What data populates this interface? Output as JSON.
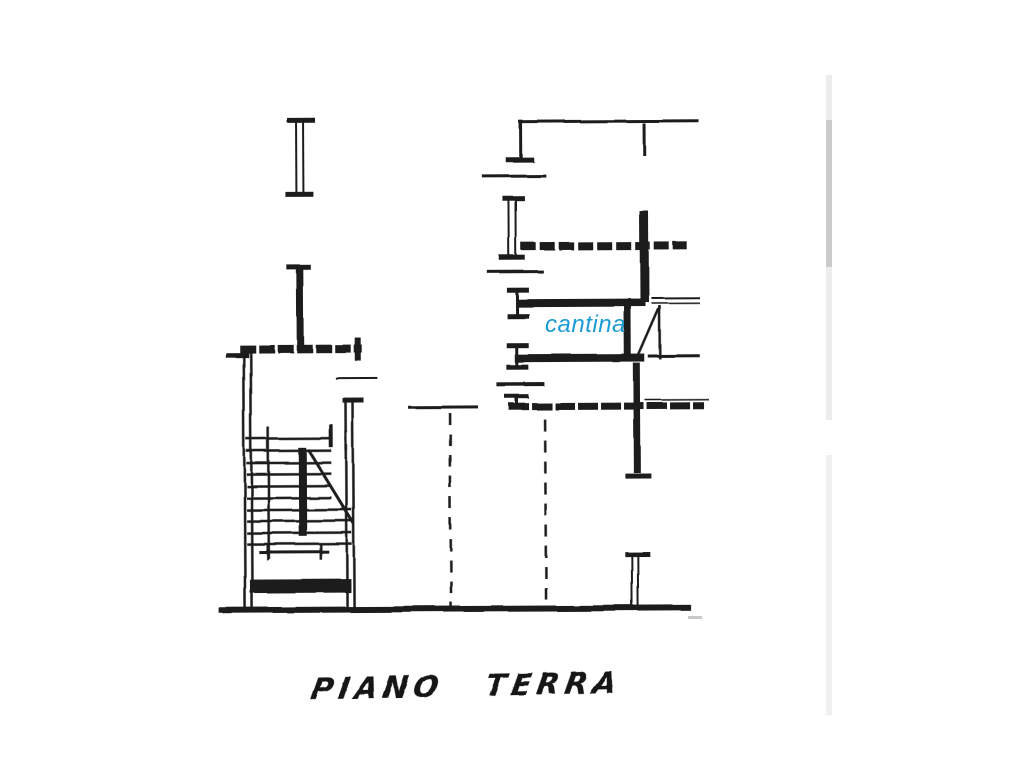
{
  "page": {
    "background": "#ffffff",
    "ink": "#1a1a1a"
  },
  "labels": {
    "cantina": {
      "text": "cantina",
      "color": "#1b9bd7"
    },
    "floor_title": {
      "text": "PIANO TERRA"
    }
  },
  "floorplan": {
    "stroke": "#1a1a1a",
    "segments": [
      {
        "n": "wall-cap",
        "x1": 288,
        "y1": 119,
        "x2": 316,
        "y2": 119,
        "w": 5
      },
      {
        "n": "wall-line",
        "x1": 297,
        "y1": 121,
        "x2": 297,
        "y2": 195,
        "w": 2
      },
      {
        "n": "wall-line",
        "x1": 304,
        "y1": 121,
        "x2": 304,
        "y2": 195,
        "w": 2
      },
      {
        "n": "wall-cap",
        "x1": 286,
        "y1": 193,
        "x2": 314,
        "y2": 193,
        "w": 5
      },
      {
        "n": "wall-cap",
        "x1": 288,
        "y1": 267,
        "x2": 312,
        "y2": 267,
        "w": 5
      },
      {
        "n": "wall",
        "x1": 301,
        "y1": 269,
        "x2": 301,
        "y2": 347,
        "w": 7
      },
      {
        "n": "wall",
        "x1": 240,
        "y1": 348,
        "x2": 362,
        "y2": 348,
        "w": 8,
        "dash": "16 3"
      },
      {
        "n": "wall-cap",
        "x1": 358,
        "y1": 337,
        "x2": 358,
        "y2": 360,
        "w": 6
      },
      {
        "n": "wall-stub",
        "x1": 226,
        "y1": 354,
        "x2": 249,
        "y2": 354,
        "w": 5
      },
      {
        "n": "wall-line",
        "x1": 244,
        "y1": 345,
        "x2": 244,
        "y2": 610,
        "w": 2.5
      },
      {
        "n": "wall-line",
        "x1": 251,
        "y1": 345,
        "x2": 251,
        "y2": 610,
        "w": 2.5
      },
      {
        "n": "wall-cap",
        "x1": 343,
        "y1": 400,
        "x2": 364,
        "y2": 400,
        "w": 5
      },
      {
        "n": "wall-line",
        "x1": 346,
        "y1": 401,
        "x2": 346,
        "y2": 610,
        "w": 2.5
      },
      {
        "n": "wall-line",
        "x1": 353,
        "y1": 401,
        "x2": 353,
        "y2": 610,
        "w": 2.5
      },
      {
        "n": "thin-line",
        "x1": 335,
        "y1": 377,
        "x2": 377,
        "y2": 377,
        "w": 2
      },
      {
        "n": "stair-step",
        "x1": 246,
        "y1": 438,
        "x2": 331,
        "y2": 438,
        "w": 2.5
      },
      {
        "n": "stair-step",
        "x1": 246,
        "y1": 450,
        "x2": 331,
        "y2": 450,
        "w": 2.5
      },
      {
        "n": "stair-step",
        "x1": 246,
        "y1": 462,
        "x2": 331,
        "y2": 462,
        "w": 2.5
      },
      {
        "n": "stair-step",
        "x1": 246,
        "y1": 473,
        "x2": 331,
        "y2": 473,
        "w": 2.5
      },
      {
        "n": "stair-step",
        "x1": 246,
        "y1": 485,
        "x2": 331,
        "y2": 485,
        "w": 2.5
      },
      {
        "n": "stair-step",
        "x1": 246,
        "y1": 497,
        "x2": 331,
        "y2": 497,
        "w": 2.5
      },
      {
        "n": "stair-step",
        "x1": 246,
        "y1": 509,
        "x2": 351,
        "y2": 509,
        "w": 2.5
      },
      {
        "n": "stair-step",
        "x1": 246,
        "y1": 520,
        "x2": 351,
        "y2": 520,
        "w": 2.5
      },
      {
        "n": "stair-step",
        "x1": 246,
        "y1": 532,
        "x2": 351,
        "y2": 532,
        "w": 2.5
      },
      {
        "n": "stair-step",
        "x1": 246,
        "y1": 543,
        "x2": 351,
        "y2": 543,
        "w": 2.5
      },
      {
        "n": "stair-stringer",
        "x1": 268,
        "y1": 426,
        "x2": 268,
        "y2": 558,
        "w": 2.5
      },
      {
        "n": "stair-rail",
        "x1": 302,
        "y1": 447,
        "x2": 302,
        "y2": 535,
        "w": 8
      },
      {
        "n": "stair-break-line",
        "x1": 308,
        "y1": 449,
        "x2": 353,
        "y2": 523,
        "w": 3
      },
      {
        "n": "stair-tick",
        "x1": 331,
        "y1": 424,
        "x2": 331,
        "y2": 447,
        "w": 4
      },
      {
        "n": "stair-tick",
        "x1": 346,
        "y1": 430,
        "x2": 346,
        "y2": 450,
        "w": 2.5
      },
      {
        "n": "landing-line",
        "x1": 258,
        "y1": 551,
        "x2": 328,
        "y2": 551,
        "w": 3
      },
      {
        "n": "landing-tick",
        "x1": 267,
        "y1": 543,
        "x2": 267,
        "y2": 559,
        "w": 2.5
      },
      {
        "n": "landing-tick",
        "x1": 320,
        "y1": 543,
        "x2": 320,
        "y2": 559,
        "w": 2.5
      },
      {
        "n": "threshold-bar",
        "x1": 249,
        "y1": 585,
        "x2": 350,
        "y2": 585,
        "w": 14
      },
      {
        "n": "ground-line",
        "x1": 218,
        "y1": 609,
        "x2": 690,
        "y2": 609,
        "w": 6
      },
      {
        "n": "wall-line",
        "x1": 520,
        "y1": 122,
        "x2": 700,
        "y2": 122,
        "w": 3
      },
      {
        "n": "wall-line",
        "x1": 522,
        "y1": 122,
        "x2": 522,
        "y2": 158,
        "w": 3
      },
      {
        "n": "wall-cap",
        "x1": 507,
        "y1": 160,
        "x2": 535,
        "y2": 160,
        "w": 5
      },
      {
        "n": "wall-line",
        "x1": 645,
        "y1": 124,
        "x2": 645,
        "y2": 156,
        "w": 3
      },
      {
        "n": "thin-line",
        "x1": 483,
        "y1": 176,
        "x2": 547,
        "y2": 176,
        "w": 3
      },
      {
        "n": "wall-cap",
        "x1": 504,
        "y1": 199,
        "x2": 526,
        "y2": 199,
        "w": 5
      },
      {
        "n": "wall-line",
        "x1": 510,
        "y1": 201,
        "x2": 510,
        "y2": 257,
        "w": 2
      },
      {
        "n": "wall-line",
        "x1": 517,
        "y1": 201,
        "x2": 517,
        "y2": 257,
        "w": 2
      },
      {
        "n": "wall-cap",
        "x1": 500,
        "y1": 258,
        "x2": 526,
        "y2": 258,
        "w": 5
      },
      {
        "n": "wall",
        "x1": 522,
        "y1": 247,
        "x2": 688,
        "y2": 247,
        "w": 8,
        "dash": "15 4"
      },
      {
        "n": "wall",
        "x1": 645,
        "y1": 212,
        "x2": 645,
        "y2": 303,
        "w": 9
      },
      {
        "n": "thin-line",
        "x1": 488,
        "y1": 272,
        "x2": 544,
        "y2": 272,
        "w": 3
      },
      {
        "n": "wall-cap",
        "x1": 507,
        "y1": 290,
        "x2": 529,
        "y2": 290,
        "w": 5
      },
      {
        "n": "wall-line",
        "x1": 517,
        "y1": 292,
        "x2": 517,
        "y2": 315,
        "w": 3
      },
      {
        "n": "wall-cap",
        "x1": 507,
        "y1": 316,
        "x2": 529,
        "y2": 316,
        "w": 5
      },
      {
        "n": "wall",
        "x1": 518,
        "y1": 303,
        "x2": 646,
        "y2": 303,
        "w": 8
      },
      {
        "n": "thin-line",
        "x1": 652,
        "y1": 299,
        "x2": 700,
        "y2": 299,
        "w": 2
      },
      {
        "n": "thin-line",
        "x1": 652,
        "y1": 304,
        "x2": 700,
        "y2": 304,
        "w": 1.5
      },
      {
        "n": "door-jamb",
        "x1": 628,
        "y1": 305,
        "x2": 628,
        "y2": 362,
        "w": 7
      },
      {
        "n": "door-jamb",
        "x1": 660,
        "y1": 306,
        "x2": 660,
        "y2": 360,
        "w": 2.5
      },
      {
        "n": "door-leaf",
        "x1": 660,
        "y1": 308,
        "x2": 637,
        "y2": 360,
        "w": 2.5
      },
      {
        "n": "wall-cap",
        "x1": 507,
        "y1": 346,
        "x2": 529,
        "y2": 346,
        "w": 5
      },
      {
        "n": "wall-line",
        "x1": 517,
        "y1": 348,
        "x2": 517,
        "y2": 367,
        "w": 3
      },
      {
        "n": "wall-cap",
        "x1": 507,
        "y1": 368,
        "x2": 529,
        "y2": 368,
        "w": 5
      },
      {
        "n": "wall",
        "x1": 515,
        "y1": 359,
        "x2": 645,
        "y2": 359,
        "w": 8
      },
      {
        "n": "thin-line",
        "x1": 648,
        "y1": 357,
        "x2": 700,
        "y2": 357,
        "w": 3
      },
      {
        "n": "thin-line",
        "x1": 497,
        "y1": 385,
        "x2": 545,
        "y2": 385,
        "w": 4
      },
      {
        "n": "wall-cap",
        "x1": 505,
        "y1": 397,
        "x2": 529,
        "y2": 397,
        "w": 4
      },
      {
        "n": "wall-line",
        "x1": 517,
        "y1": 398,
        "x2": 517,
        "y2": 407,
        "w": 3
      },
      {
        "n": "wall",
        "x1": 509,
        "y1": 407,
        "x2": 704,
        "y2": 407,
        "w": 7,
        "dash": "20 3"
      },
      {
        "n": "thin-line",
        "x1": 645,
        "y1": 401,
        "x2": 709,
        "y2": 401,
        "w": 1.5
      },
      {
        "n": "wall",
        "x1": 637,
        "y1": 364,
        "x2": 637,
        "y2": 474,
        "w": 7
      },
      {
        "n": "wall-cap",
        "x1": 625,
        "y1": 477,
        "x2": 651,
        "y2": 477,
        "w": 5
      },
      {
        "n": "wall-cap",
        "x1": 624,
        "y1": 555,
        "x2": 649,
        "y2": 555,
        "w": 5
      },
      {
        "n": "wall-line",
        "x1": 631,
        "y1": 557,
        "x2": 631,
        "y2": 609,
        "w": 2
      },
      {
        "n": "wall-line",
        "x1": 637,
        "y1": 557,
        "x2": 637,
        "y2": 609,
        "w": 2
      },
      {
        "n": "thin-line",
        "x1": 408,
        "y1": 407,
        "x2": 478,
        "y2": 407,
        "w": 3
      },
      {
        "n": "dashed-boundary",
        "x1": 450,
        "y1": 413,
        "x2": 450,
        "y2": 608,
        "w": 2.5,
        "dash": "12 9"
      },
      {
        "n": "dashed-boundary",
        "x1": 545,
        "y1": 420,
        "x2": 545,
        "y2": 608,
        "w": 2.5,
        "dash": "12 9"
      }
    ],
    "artifacts": [
      {
        "n": "scan-artifact-strip",
        "x": 826,
        "y": 75,
        "w": 6,
        "h": 345,
        "c": "#ededed"
      },
      {
        "n": "scan-artifact-strip",
        "x": 826,
        "y": 120,
        "w": 6,
        "h": 147,
        "c": "#cbcbcb"
      },
      {
        "n": "scan-artifact-strip",
        "x": 826,
        "y": 455,
        "w": 6,
        "h": 260,
        "c": "#f0f0f0"
      },
      {
        "n": "scan-artifact-mark",
        "x": 688,
        "y": 616,
        "w": 14,
        "h": 3,
        "c": "#c9c9c9"
      }
    ]
  }
}
